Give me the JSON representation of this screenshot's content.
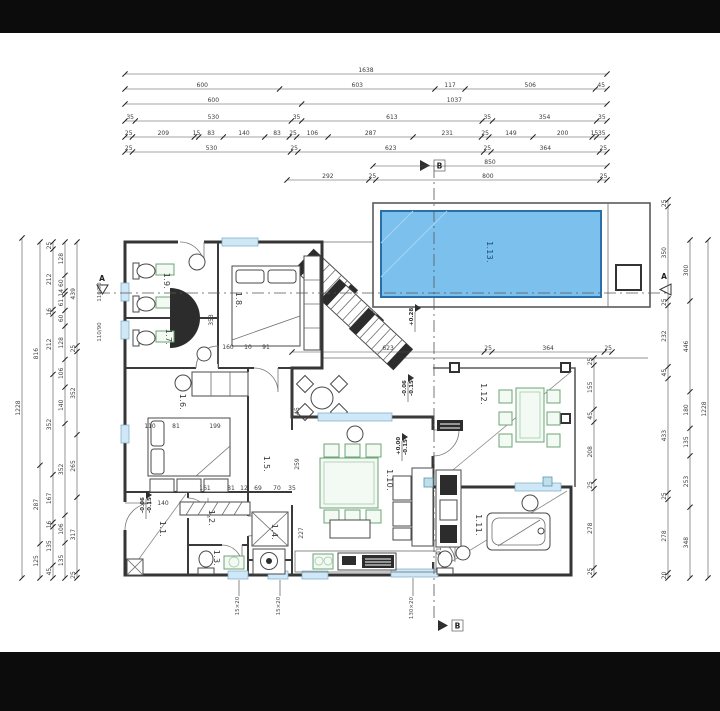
{
  "colors": {
    "background": "#0c0c0c",
    "paper": "#ffffff",
    "pool_fill": "#7cc0ee",
    "pool_border": "#2b6fa8",
    "window_fill": "#cfe8f7",
    "accent_green": "#6ea476"
  },
  "rooms": [
    "1.1.",
    "1.2.",
    "1.3.",
    "1.4.",
    "1.5.",
    "1.6.",
    "1.7.",
    "1.8.",
    "1.9.",
    "1.10.",
    "1.11.",
    "1.12.",
    "1.13."
  ],
  "dims": {
    "top": {
      "r1": [
        "1638"
      ],
      "r2": [
        "600",
        "603",
        "117",
        "506",
        "45"
      ],
      "r3": [
        "600",
        "1037"
      ],
      "r4": [
        "35",
        "530",
        "35",
        "613",
        "35",
        "354",
        "35"
      ],
      "r5": [
        "25",
        "209",
        "15",
        "83",
        "140",
        "83",
        "25",
        "106",
        "287",
        "231",
        "25",
        "149",
        "200",
        "15",
        "35"
      ],
      "r6": [
        "25",
        "530",
        "25",
        "623",
        "25",
        "364",
        "25"
      ],
      "r7": [
        "850"
      ],
      "r8": [
        "292",
        "25",
        "800",
        "25"
      ],
      "r9": [
        "623",
        "25",
        "364",
        "25"
      ]
    },
    "left": {
      "c1": [
        "1228"
      ],
      "c2": [
        "816",
        "287",
        "125"
      ],
      "c3": [
        "25",
        "212",
        "16",
        "212",
        "352",
        "167",
        "16",
        "135",
        "45"
      ],
      "c4": [
        "128",
        "60",
        "14",
        "61",
        "60",
        "128",
        "106",
        "140",
        "352",
        "106",
        "135"
      ],
      "c5": [
        "439",
        "25",
        "352",
        "265",
        "317",
        "25"
      ]
    },
    "right": {
      "r1": [
        "25",
        "155",
        "45",
        "208",
        "25",
        "278",
        "25"
      ],
      "r2": [
        "25",
        "350",
        "25",
        "232",
        "45",
        "433",
        "25",
        "278",
        "20"
      ],
      "r3": [
        "300",
        "446",
        "180",
        "135",
        "253",
        "348"
      ],
      "r4": [
        "1228"
      ]
    },
    "inner": [
      "353",
      "160",
      "10",
      "91",
      "110",
      "81",
      "199",
      "140",
      "161",
      "81",
      "12",
      "69",
      "70",
      "35",
      "45",
      "259",
      "227",
      "91"
    ]
  },
  "elevations": [
    {
      "a": "+0.28",
      "b": ""
    },
    {
      "a": "-0.06",
      "b": "-0.15"
    },
    {
      "a": "+0.00",
      "b": "-0.15"
    },
    {
      "a": "-0.06",
      "b": "-0.15"
    }
  ],
  "sections": {
    "a": "A",
    "b": "B"
  },
  "window_tags": [
    "15×20",
    "15×20",
    "130×20",
    "110/90",
    "110/90"
  ]
}
